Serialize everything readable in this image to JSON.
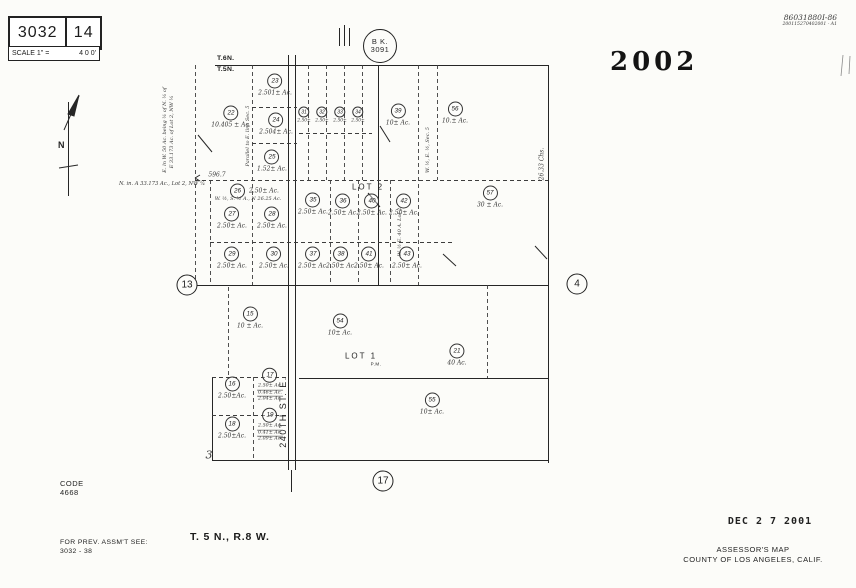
{
  "title_block": {
    "book": "3032",
    "sheet": "14",
    "scale_label": "SCALE 1\" =",
    "scale_value": "4 0 0'"
  },
  "top_right": {
    "handwritten_id": "86031880I-86",
    "handwritten_sub": "200115270402001 - A1",
    "year_stamp": "2002"
  },
  "book_circle": {
    "line1": "B K.",
    "line2": "3091"
  },
  "township_line": {
    "above": "T.6N.",
    "below": "T.5N."
  },
  "compass": {
    "label": "N"
  },
  "street": {
    "name": "240TH  ST. E."
  },
  "lot_labels": [
    {
      "text": "LOT 2",
      "x": 368,
      "y": 187,
      "small": false
    },
    {
      "text": "LOT 1",
      "x": 361,
      "y": 356,
      "small": false
    },
    {
      "text": "P.M.",
      "x": 376,
      "y": 364,
      "small": true
    }
  ],
  "section_markers": [
    {
      "num": "13",
      "x": 187,
      "y": 285
    },
    {
      "num": "4",
      "x": 577,
      "y": 284
    },
    {
      "num": "17",
      "x": 383,
      "y": 481
    }
  ],
  "parcels": [
    {
      "n": "23",
      "a": "2.501± Ac.",
      "x": 275,
      "y": 85
    },
    {
      "n": "22",
      "a": "10.405 ± Ac.",
      "x": 231,
      "y": 117
    },
    {
      "n": "24",
      "a": "2.504± Ac.",
      "x": 276,
      "y": 124
    },
    {
      "n": "25",
      "a": "1.52± Ac.",
      "x": 272,
      "y": 161
    },
    {
      "n": "31",
      "a": "2.50±",
      "x": 304,
      "y": 115,
      "small": true
    },
    {
      "n": "32",
      "a": "2.50±",
      "x": 322,
      "y": 115,
      "small": true
    },
    {
      "n": "33",
      "a": "2.50±",
      "x": 340,
      "y": 115,
      "small": true
    },
    {
      "n": "34",
      "a": "2.50±",
      "x": 358,
      "y": 115,
      "small": true
    },
    {
      "n": "39",
      "a": "10± Ac.",
      "x": 398,
      "y": 115
    },
    {
      "n": "56",
      "a": "10.± Ac.",
      "x": 455,
      "y": 113
    },
    {
      "n": "57",
      "a": "30 ± Ac.",
      "x": 490,
      "y": 197
    },
    {
      "n": "26",
      "a": "2.50± Ac.",
      "x": 230,
      "y": 191,
      "anchor": "left"
    },
    {
      "n": "27",
      "a": "2.50± Ac.",
      "x": 232,
      "y": 218
    },
    {
      "n": "28",
      "a": "2.50± Ac.",
      "x": 272,
      "y": 218
    },
    {
      "n": "35",
      "a": "2.50± Ac.",
      "x": 313,
      "y": 204
    },
    {
      "n": "36",
      "a": "2.50± Ac.",
      "x": 343,
      "y": 205
    },
    {
      "n": "40",
      "a": "2.50± Ac.",
      "x": 372,
      "y": 205
    },
    {
      "n": "42",
      "a": "2.50± Ac.",
      "x": 404,
      "y": 205
    },
    {
      "n": "29",
      "a": "2.50± Ac.",
      "x": 232,
      "y": 258
    },
    {
      "n": "30",
      "a": "2.50± Ac.",
      "x": 274,
      "y": 258
    },
    {
      "n": "37",
      "a": "2.50± Ac.",
      "x": 313,
      "y": 258
    },
    {
      "n": "38",
      "a": "2.50± Ac.",
      "x": 341,
      "y": 258
    },
    {
      "n": "41",
      "a": "2.50± Ac.",
      "x": 369,
      "y": 258
    },
    {
      "n": "43",
      "a": "2.50± Ac.",
      "x": 407,
      "y": 258
    },
    {
      "n": "15",
      "a": "10 ± Ac.",
      "x": 250,
      "y": 318
    },
    {
      "n": "54",
      "a": "10± Ac.",
      "x": 340,
      "y": 325
    },
    {
      "n": "21",
      "a": "40 Ac.",
      "x": 457,
      "y": 355
    },
    {
      "n": "16",
      "a": "2.50±Ac.",
      "x": 232,
      "y": 388
    },
    {
      "n": "17",
      "lines": [
        "2.50± Ac.",
        "0.46± Ac.",
        "2.04± Ac."
      ],
      "x": 270,
      "y": 385
    },
    {
      "n": "18",
      "a": "2.50±Ac.",
      "x": 232,
      "y": 428
    },
    {
      "n": "19",
      "lines": [
        "2.50± Ac.",
        "0.41± Ac.",
        "2.09± Ac."
      ],
      "x": 270,
      "y": 425
    },
    {
      "n": "55",
      "a": "10± Ac.",
      "x": 432,
      "y": 404
    }
  ],
  "annotations": [
    {
      "text": "596.7",
      "x": 217,
      "y": 175,
      "size": 6
    },
    {
      "text": "N. in. A 33.173 Ac., Lot 2, NW ¼",
      "x": 162,
      "y": 184,
      "size": 5.2
    },
    {
      "text": "E. ln W. 50 Ac. being ¼ of N. ¼ of",
      "x": 165,
      "y": 130,
      "size": 5,
      "rot": -90
    },
    {
      "text": "E 33.173 Ac. of Lot 2, NW ¼",
      "x": 172,
      "y": 132,
      "size": 5,
      "rot": -90
    },
    {
      "text": "Parallel to E. line Sec. 5",
      "x": 248,
      "y": 136,
      "size": 5,
      "rot": -90
    },
    {
      "text": "W. ½, E. ½, Sec. 5",
      "x": 428,
      "y": 150,
      "size": 5,
      "rot": -90
    },
    {
      "text": "W. ½ E. 40 A. Lot 2",
      "x": 400,
      "y": 232,
      "size": 5,
      "rot": -90
    },
    {
      "text": "26.33 Chs.",
      "x": 542,
      "y": 164,
      "size": 6,
      "rot": -90
    },
    {
      "text": "W. ½, S. ½ A., N 26.25 Ac.",
      "x": 248,
      "y": 199,
      "size": 5
    },
    {
      "text": "3",
      "x": 209,
      "y": 455,
      "size": 11
    }
  ],
  "footer": {
    "code_label": "CODE",
    "code_value": "4668",
    "prev_label": "FOR  PREV.  ASSM'T  SEE:",
    "prev_value": "3032 - 38",
    "township_range": "T. 5 N., R.8 W.",
    "date_stamp": "DEC 2 7 2001",
    "assessor_line1": "ASSESSOR'S  MAP",
    "assessor_line2": "COUNTY  OF  LOS  ANGELES,  CALIF."
  }
}
